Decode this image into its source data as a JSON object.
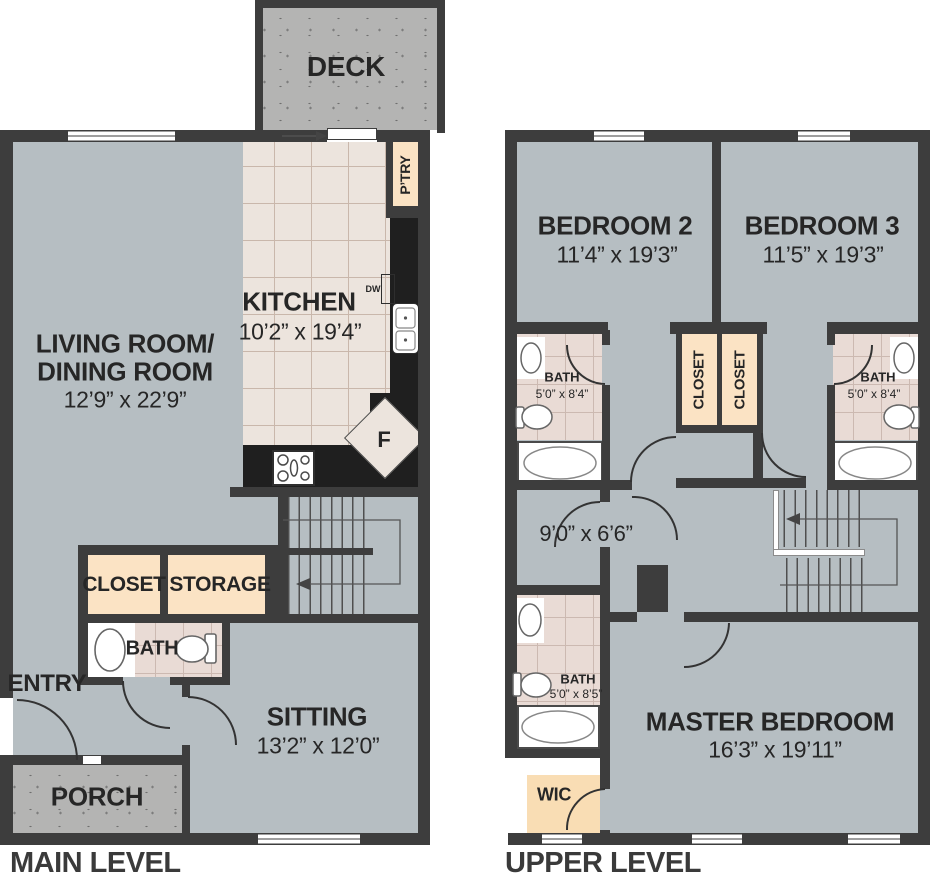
{
  "title": "Two-level townhome floor plan",
  "colors": {
    "wall": "#3d3d3d",
    "floor_gray": "#b6bec2",
    "kitchen_floor": "#ece4dd",
    "bath_tile": "#e9dbd5",
    "closet_peach": "#fbe3c4",
    "deck_gray": "#b4b4b3",
    "counter_black": "#1f1f1f",
    "text": "#262626"
  },
  "main_level": {
    "level_label": "MAIN LEVEL",
    "deck": "DECK",
    "living_room_line1": "LIVING ROOM/",
    "living_room_line2": "DINING ROOM",
    "living_room_dims": "12’9” x 22’9”",
    "kitchen": "KITCHEN",
    "kitchen_dims": "10’2” x 19’4”",
    "pantry": "P’TRY",
    "dishwasher": "DW",
    "fridge": "F",
    "closet": "CLOSET",
    "storage": "STORAGE",
    "bath": "BATH",
    "entry": "ENTRY",
    "porch": "PORCH",
    "sitting": "SITTING",
    "sitting_dims": "13’2” x 12’0”"
  },
  "upper_level": {
    "level_label": "UPPER LEVEL",
    "bedroom2": "BEDROOM 2",
    "bedroom2_dims": "11’4” x 19’3”",
    "bedroom3": "BEDROOM 3",
    "bedroom3_dims": "11’5” x 19’3”",
    "bath2": "BATH",
    "bath2_dims": "5’0” x 8’4”",
    "bath3": "BATH",
    "bath3_dims": "5’0” x 8’4”",
    "closet_left": "CLOSET",
    "closet_right": "CLOSET",
    "hall_dims": "9’0” x 6’6”",
    "master_bath": "BATH",
    "master_bath_dims": "5’0” x 8’5”",
    "wic": "WIC",
    "master_bedroom": "MASTER BEDROOM",
    "master_bedroom_dims": "16’3” x 19’11”"
  }
}
